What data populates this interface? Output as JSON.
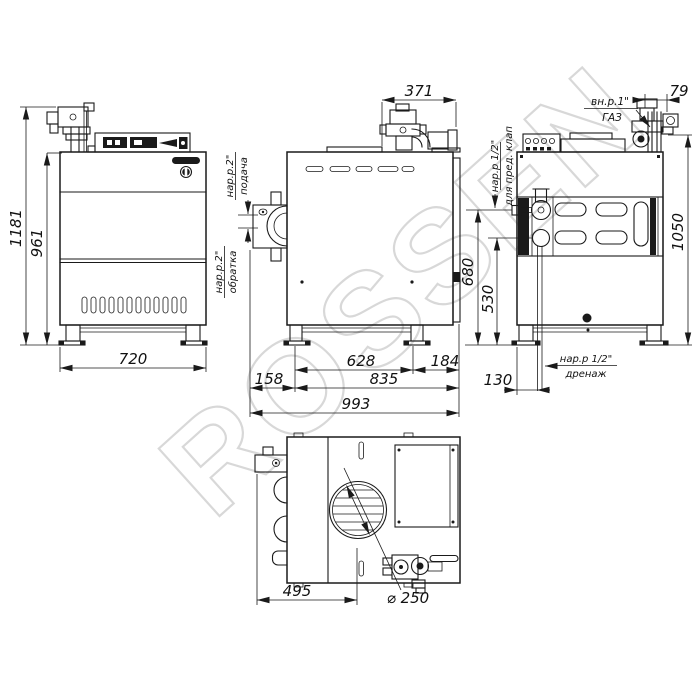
{
  "watermark": "ROSSEN",
  "dims": {
    "total_height": "1181",
    "body_height": "961",
    "front_width": "720",
    "top_assembly_depth": "371",
    "gas_offset": "79",
    "rear_height": "1050",
    "supply_port_height": "680",
    "return_port_height": "530",
    "leg_spacing": "628",
    "rear_overhang": "184",
    "front_overhang": "158",
    "body_depth": "835",
    "total_depth": "993",
    "drain_offset": "130",
    "plan_width": "495",
    "flue_diameter": "⌀ 250"
  },
  "labels": {
    "gas_thread": "вн.р.1\"",
    "gas": "ГАЗ",
    "supply_thread": "нар.р.2\"",
    "supply": "подача",
    "return_thread": "нар.р.2\"",
    "return": "обратка",
    "safety_thread": "нар.р 1/2\"",
    "safety": "для пред. клап",
    "drain_thread": "нар.р 1/2\"",
    "drain": "дренаж"
  }
}
